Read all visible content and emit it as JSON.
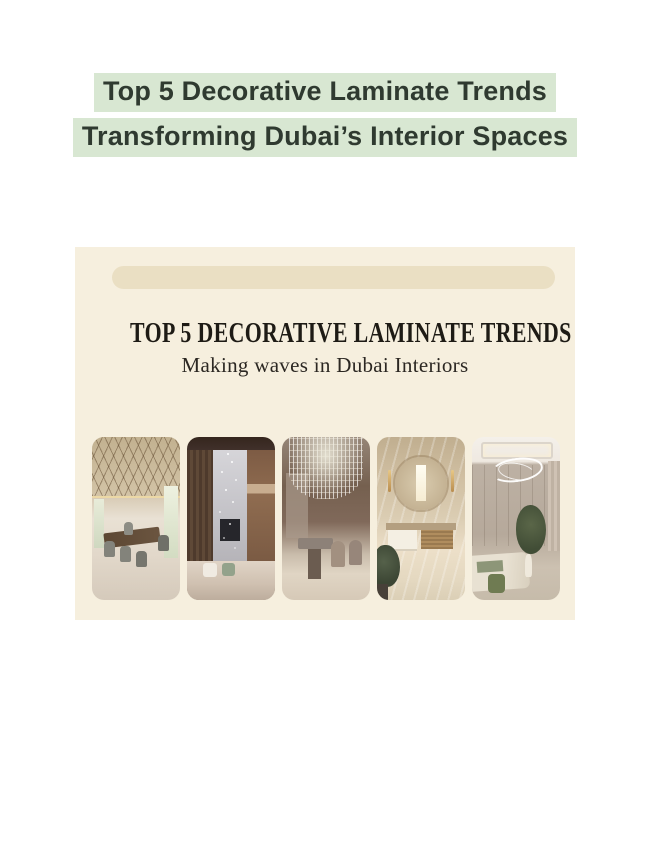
{
  "page": {
    "title": {
      "line1": "Top 5 Decorative Laminate Trends",
      "line2": "Transforming Dubai’s Interior Spaces"
    }
  },
  "banner": {
    "heading": "TOP 5 DECORATIVE LAMINATE TRENDS",
    "subheading": "Making waves in Dubai Interiors",
    "photos": [
      {
        "name": "luxury-dining-room-photo"
      },
      {
        "name": "double-height-living-room-photo"
      },
      {
        "name": "crystal-chandelier-dining-photo"
      },
      {
        "name": "marble-bathroom-vanity-photo"
      },
      {
        "name": "neutral-bedroom-photo"
      }
    ]
  },
  "colors": {
    "page_background": "#ffffff",
    "title_highlight": "#d8e7d2",
    "title_text": "#2f3a30",
    "banner_background": "#f6efde",
    "banner_pill": "#eadfc3",
    "banner_heading_text": "#1e1b15"
  }
}
